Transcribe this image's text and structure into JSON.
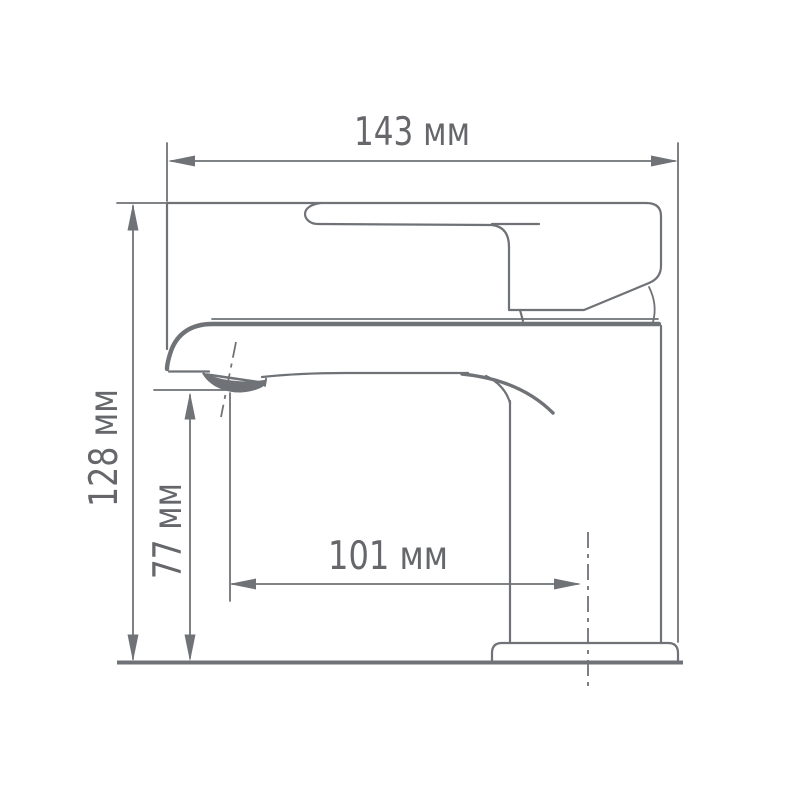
{
  "page": {
    "background_color": "#FFFFFF"
  },
  "drawing": {
    "type": "technical-dimension-drawing",
    "subject": "single-lever-basin-faucet-side-view",
    "units": "мм",
    "colors": {
      "line": "#6F7276",
      "text": "#65676B",
      "background": "#FFFFFF"
    },
    "dimensions": {
      "overall_length": {
        "label": "143 мм",
        "value": 143,
        "orientation": "horizontal",
        "position": "top"
      },
      "overall_height": {
        "label": "128 мм",
        "value": 128,
        "orientation": "vertical",
        "position": "far-left"
      },
      "spout_height": {
        "label": "77 мм",
        "value": 77,
        "orientation": "vertical",
        "position": "inner-left"
      },
      "spout_reach": {
        "label": "101 мм",
        "value": 101,
        "orientation": "horizontal",
        "position": "center"
      }
    }
  }
}
